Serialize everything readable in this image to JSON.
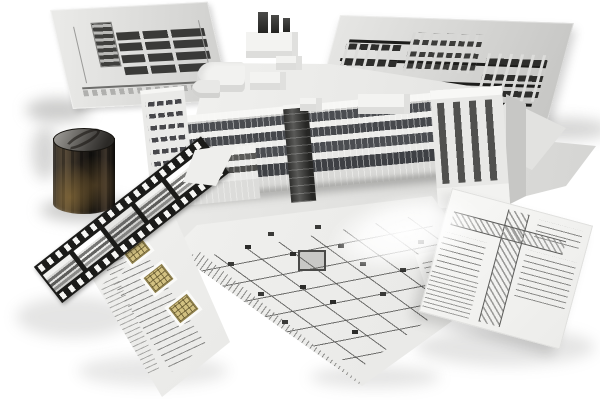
{
  "scene": {
    "description": "Architectural BIM concept collage: a white 3D building massing model standing on gray decks, surrounded by two standing elevation drawing sheets, a floor plan sheet, a construction detail sheet, a schedule sheet with yellow plan stamps, a film strip of building renders, and a dark cylindrical interior panorama render, all on a white background with a specular light streak",
    "background_color": "#ffffff"
  },
  "objects": {
    "left_elevation_sheet": {
      "label": "standing elevation drawing sheet (left)",
      "paper": "#e6e6e4",
      "ink": "#3a3a38"
    },
    "right_elevation_sheet": {
      "label": "standing elevation drawing sheet (right)",
      "paper": "#e0e0de",
      "ink": "#1d1d1b"
    },
    "building_model": {
      "label": "white 3D building massing model",
      "body": "#f2f2f0",
      "glass": "#46484c"
    },
    "base_platform": {
      "label": "gray base deck under the model",
      "color": "#e4e4e2"
    },
    "cylinder_panorama": {
      "label": "cylindrical interior render",
      "metal": "#8f8d89",
      "wood": "#6b5738",
      "dark": "#14120f"
    },
    "film_strip": {
      "label": "film strip with building render frames",
      "film": "#1b1b19",
      "frames_visible": 5
    },
    "schedule_sheet": {
      "label": "schedule sheet with yellow plan stamps",
      "paper": "#f4f4f2",
      "stamp": "#d2c182",
      "stamps_visible": 3
    },
    "floor_plan_sheet": {
      "label": "floor plan drawing sheet",
      "paper": "#f1f1ef",
      "ink": "#4a4a48"
    },
    "detail_sheet": {
      "label": "construction detail drawing sheet",
      "paper": "#f7f7f5",
      "hatch": "#8e8e8c"
    },
    "light_streak": {
      "label": "specular highlight across the drawings",
      "color": "#ffffff"
    }
  }
}
